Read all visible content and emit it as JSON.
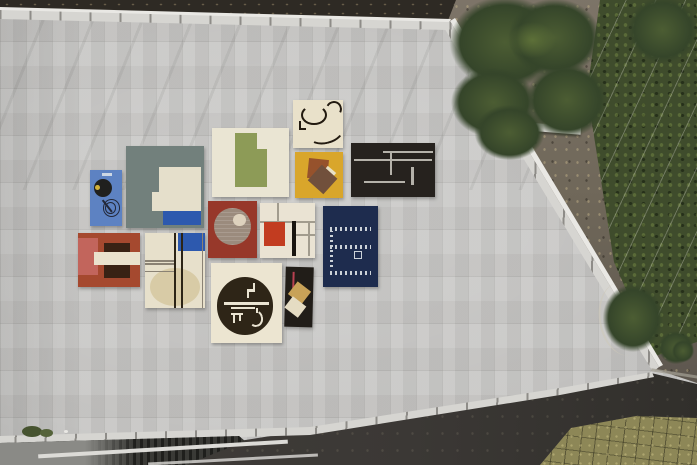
{
  "scene": {
    "description": "Aerial photograph looking straight down on a large flat rooftop clad in light gray tiles. Thirteen modernist-patterned rugs are laid out in a loose grid at the center of the roof. The roof edge runs diagonally to a point at the right; outside it are a gravel path strewn with leaves, tree canopies, a hedge with a wire fence, a dark asphalt drive, grass pavers in the lower right corner, and a lower service deck with metal grating along the bottom left.",
    "type": "aerial-photo",
    "visible_text": ""
  },
  "palette": {
    "roof_base": "#c6c5c3",
    "parapet": "#d6d5d1",
    "rail": "#e9e8e4",
    "path_dark": "#2e2a24",
    "gravel_light": "#7e7569",
    "gravel_dark": "#56504a",
    "tree_dark": "#35452a",
    "tree_mid": "#4c5d33",
    "tree_light": "#5d7038",
    "hedge": "#3f4c2c",
    "wall_light": "#ccccc6",
    "asphalt": "#413e3a",
    "grass_base": "#8d8757",
    "deck_base": "#8a8a86",
    "deck_dark": "#2c2c28",
    "beam": "#dcdbd7",
    "curb": "#a09c90",
    "plant": "#46532f"
  },
  "rugs": [
    {
      "id": "r1",
      "name": "blue-spiral-rug",
      "description": "tall blue rug with black disc, yellow dot and spiral line drawing",
      "colors": {
        "bg": "#5d82c2",
        "disc": "#20201e",
        "dot": "#d2b13a",
        "line": "#232838",
        "label": "#cdd7e4"
      }
    },
    {
      "id": "r2",
      "name": "slate-field-rug",
      "description": "large slate gray rug with inset cream panel and blue bar",
      "colors": {
        "bg": "#72807c",
        "cream": "#e5dfcb",
        "blue": "#2d59ae"
      }
    },
    {
      "id": "r3",
      "name": "green-step-rug",
      "description": "cream rug with olive-green stepped rectangle",
      "colors": {
        "bg": "#eae5d3",
        "green": "#8d9b57"
      }
    },
    {
      "id": "r4",
      "name": "arc-lines-rug",
      "description": "cream rug with thin black arcs and bracket",
      "colors": {
        "bg": "#e9e1ca",
        "line": "#221a10"
      }
    },
    {
      "id": "r5",
      "name": "yellow-squares-rug",
      "description": "golden yellow rug with two overlapping rotated brown squares and cream wedge",
      "colors": {
        "bg": "#d9a62b",
        "brown1": "#96522c",
        "brown2": "#71503c",
        "cream": "#e9e1c6"
      }
    },
    {
      "id": "r6",
      "name": "black-grid-rug",
      "description": "black rug with light gray constructivist line composition",
      "colors": {
        "bg": "#26221e",
        "line": "#b5b2aa"
      }
    },
    {
      "id": "r7",
      "name": "rust-circle-rug",
      "description": "rust red rug with large taupe circle and small cream moon",
      "colors": {
        "bg": "#97382a",
        "taupe": "#9b8b7d",
        "cream": "#ded2be"
      }
    },
    {
      "id": "r8",
      "name": "mondrian-rug",
      "description": "cream rug with red square, black bar and thin grid lines",
      "colors": {
        "bg": "#eae3d3",
        "red": "#c23c20",
        "bar": "#191510",
        "line": "#a29c8e"
      }
    },
    {
      "id": "r9",
      "name": "navy-script-rug",
      "description": "navy rug with rows of small white script-like dashes and square emblem",
      "colors": {
        "bg": "#1e2c4e",
        "dash": "#ccd2d8"
      }
    },
    {
      "id": "r10",
      "name": "red-blocks-rug",
      "description": "terracotta rug with rose column, cream band and dark brown blocks",
      "colors": {
        "bg": "#a5492f",
        "pink": "#c2655c",
        "cream": "#eae2cd",
        "brown": "#392214"
      }
    },
    {
      "id": "r11",
      "name": "column-circle-rug",
      "description": "tall cream rug with vertical rules, blue corner block and pale circle",
      "colors": {
        "bg": "#e7e0cb",
        "tan": "#d8cba6",
        "blue": "#2d59ae",
        "line": "#2c2416",
        "line2": "#8a8274"
      }
    },
    {
      "id": "r12",
      "name": "glyph-circle-rug",
      "description": "cream rug with large dark circle containing white numeral-like glyphs",
      "colors": {
        "bg": "#ece5d1",
        "circle": "#2e2517",
        "glyph": "#eae4d2"
      }
    },
    {
      "id": "r13",
      "name": "tilted-tiles-rug",
      "description": "small black rug with tilted tan and cream rectangles and red line",
      "colors": {
        "bg": "#211d18",
        "tan": "#c8a258",
        "cream": "#e5dcc3",
        "red": "#b84050"
      }
    }
  ],
  "environment_features": [
    {
      "name": "rooftop-surface",
      "color_key": "roof_base"
    },
    {
      "name": "roof-parapet",
      "color_key": "parapet"
    },
    {
      "name": "upper-path-asphalt",
      "color_key": "path_dark"
    },
    {
      "name": "gravel-road",
      "color_key": "gravel_light"
    },
    {
      "name": "tree-canopy",
      "color_key": "tree_mid"
    },
    {
      "name": "hedge-fence-strip",
      "color_key": "hedge"
    },
    {
      "name": "boundary-wall",
      "color_key": "wall_light"
    },
    {
      "name": "asphalt-driveway",
      "color_key": "asphalt"
    },
    {
      "name": "grass-pavers",
      "color_key": "grass_base"
    },
    {
      "name": "lower-deck",
      "color_key": "deck_base"
    }
  ]
}
